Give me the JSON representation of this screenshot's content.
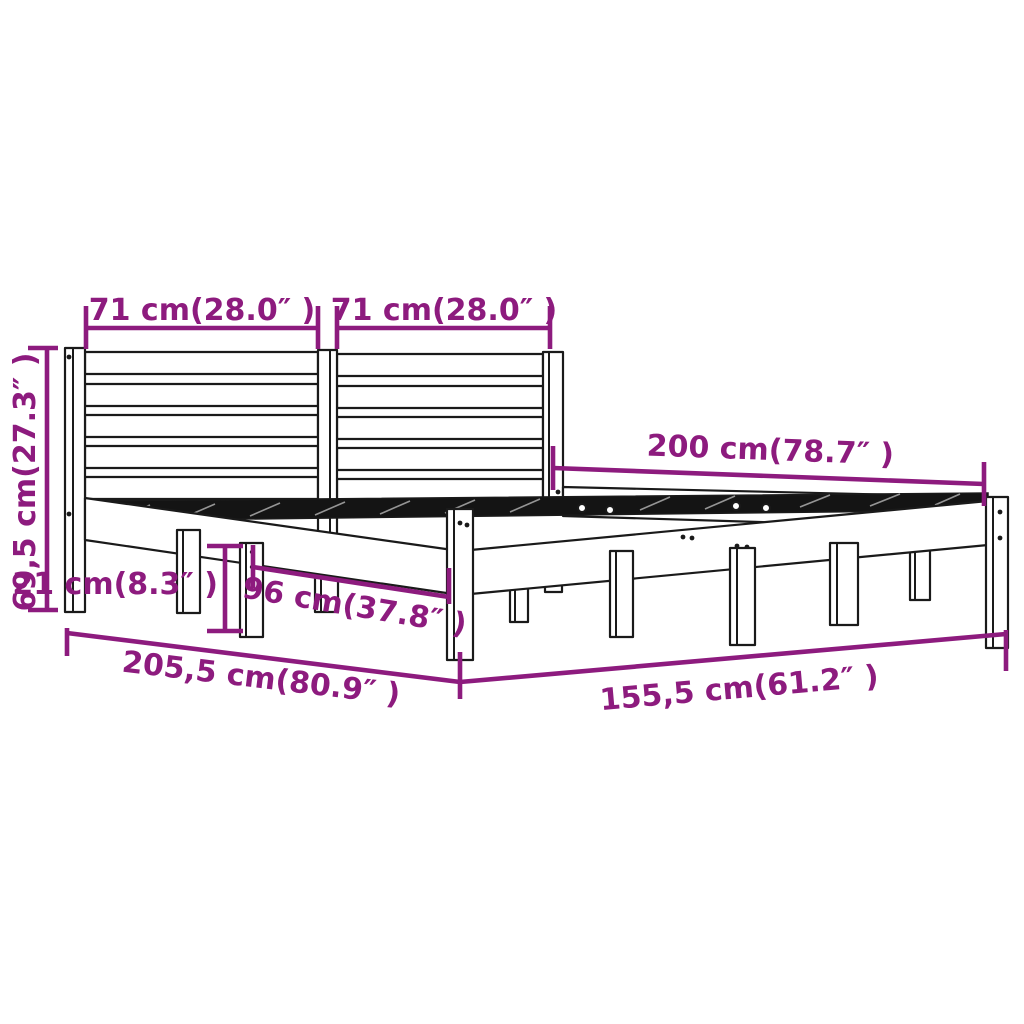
{
  "diagram": {
    "title": "bed-frame-dimension-diagram",
    "product": "wood bed frame with slatted headboard",
    "background_color": "#ffffff",
    "drawing_line_color": "#1a1a1a",
    "accent_color": "#8D1B7E",
    "dimensions": [
      {
        "id": "headboard-left-section-width",
        "label": "71 cm(28.0″ )"
      },
      {
        "id": "headboard-right-section-width",
        "label": "71 cm(28.0″ )"
      },
      {
        "id": "frame-length",
        "label": "200 cm(78.7″ )"
      },
      {
        "id": "headboard-height",
        "label": "69,5 cm(27.3″ )"
      },
      {
        "id": "leg-height",
        "label": "21 cm(8.3″ )"
      },
      {
        "id": "inner-span",
        "label": "96 cm(37.8″ )"
      },
      {
        "id": "total-length",
        "label": "205,5 cm(80.9″ )"
      },
      {
        "id": "total-width",
        "label": "155,5 cm(61.2″ )"
      }
    ]
  }
}
